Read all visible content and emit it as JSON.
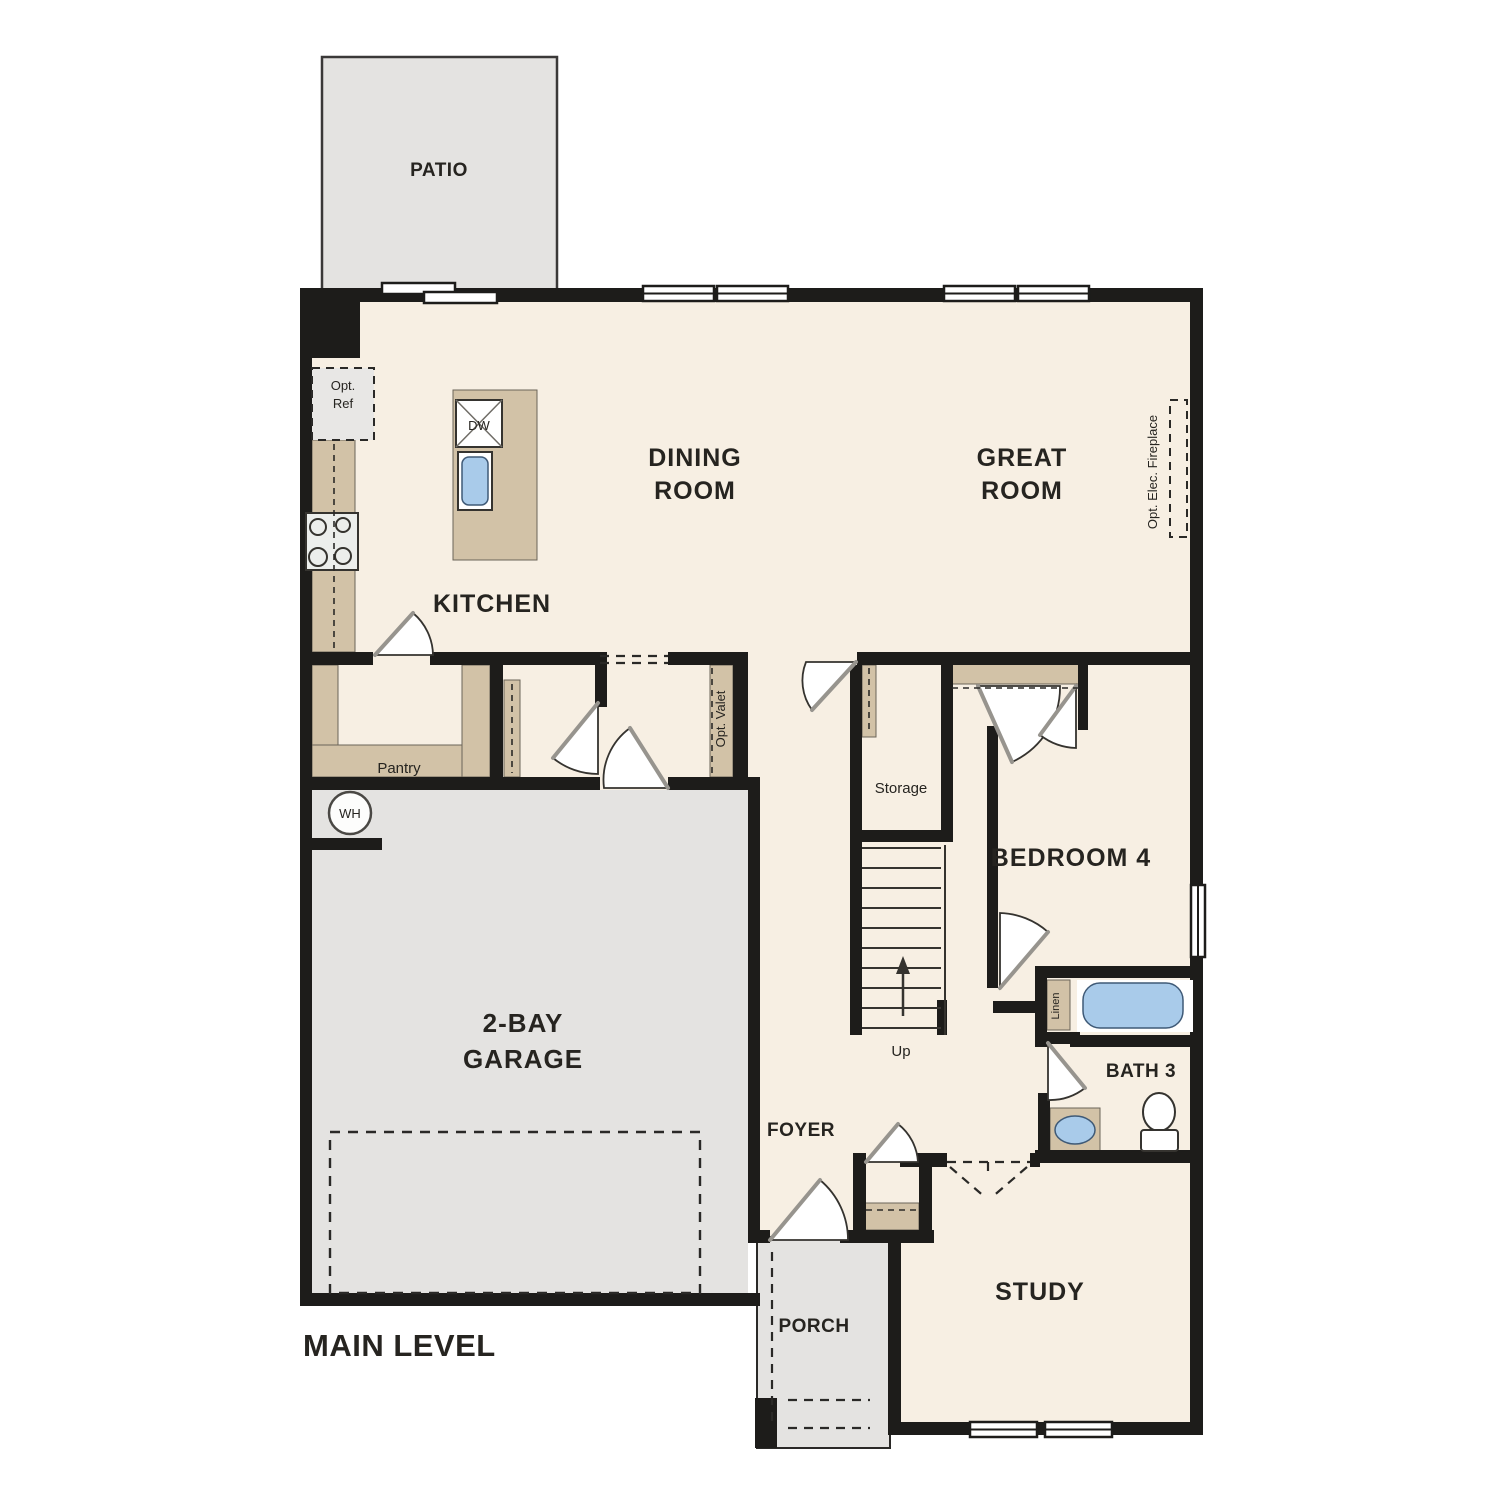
{
  "plan_title": "MAIN LEVEL",
  "rooms": {
    "patio": "PATIO",
    "dining_line1": "DINING",
    "dining_line2": "ROOM",
    "great_line1": "GREAT",
    "great_line2": "ROOM",
    "kitchen": "KITCHEN",
    "bedroom4": "BEDROOM 4",
    "bath3": "BATH 3",
    "garage_line1": "2-BAY",
    "garage_line2": "GARAGE",
    "foyer": "FOYER",
    "study": "STUDY",
    "porch": "PORCH",
    "storage": "Storage",
    "pantry": "Pantry"
  },
  "annotations": {
    "opt_ref_line1": "Opt.",
    "opt_ref_line2": "Ref",
    "dishwasher": "DW",
    "opt_elec_fireplace": "Opt. Elec. Fireplace",
    "opt_valet": "Opt. Valet",
    "water_heater": "WH",
    "up": "Up",
    "linen": "Linen"
  },
  "colors": {
    "floor": "#f7efe3",
    "outdoor": "#e4e3e1",
    "wall": "#1d1c1a",
    "wood": "#d2c2a7",
    "water": "#a9cbea",
    "dash": "#2a2927",
    "line": "#35332f",
    "text": "#262420"
  }
}
